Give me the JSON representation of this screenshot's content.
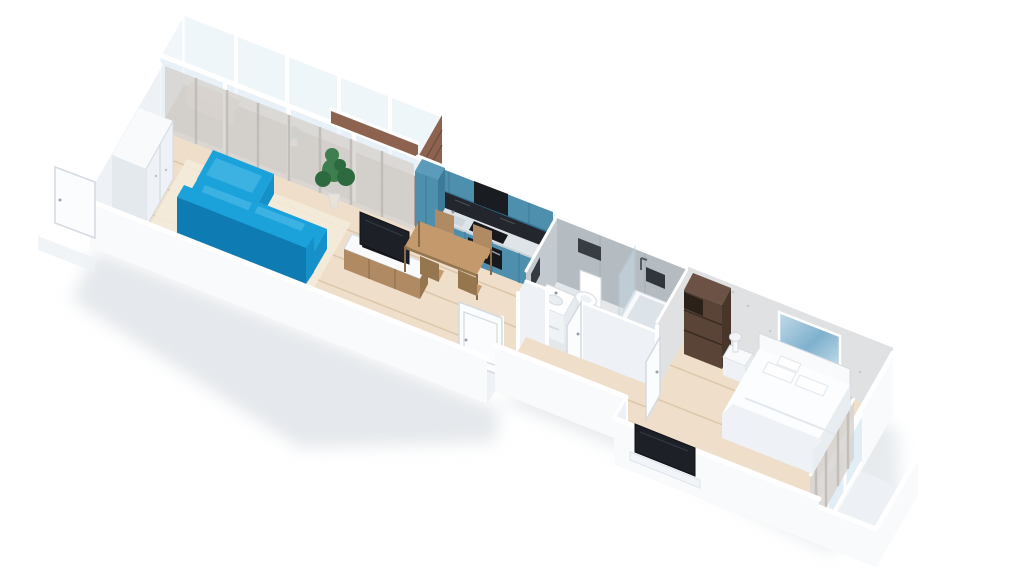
{
  "scene": {
    "title": "3D isometric render of a one-bedroom apartment floor plan on a white background",
    "view": "isometric cutaway dollhouse view, no text labels",
    "rooms": [
      {
        "name": "balcony",
        "features": [
          "glazed window wall",
          "dark wood deck",
          "wood bench",
          "small potted plant",
          "sheer curtains"
        ]
      },
      {
        "name": "living-room-kitchen",
        "features": [
          "blue corner sofa",
          "light rug",
          "white wardrobe",
          "tv sideboard with tv and soundbar",
          "tall potted plant",
          "dining table with four chairs",
          "teal kitchen cabinets",
          "dark stone backsplash",
          "built-in oven and cooktop",
          "sink"
        ]
      },
      {
        "name": "hallway",
        "features": [
          "light wood floor",
          "open white interior doors",
          "entrance door ajar"
        ]
      },
      {
        "name": "bathroom",
        "features": [
          "grey tile walls",
          "bathtub with glass screen",
          "shower fixture",
          "toilet",
          "vanity with mirror",
          "washing machine"
        ]
      },
      {
        "name": "bedroom",
        "features": [
          "double bed with white bedding and pillows",
          "upholstered headboard",
          "white nightstand with lamp",
          "dark brown wardrobe",
          "abstract blue wall art",
          "speckled wallpaper",
          "curtained window wall",
          "tv on low stand"
        ]
      },
      {
        "name": "bedroom-balcony",
        "features": [
          "white parapet walls"
        ]
      }
    ]
  },
  "colors": {
    "background": "#ffffff",
    "white": "#ffffff",
    "shadow": "#ccd2d9",
    "wallWhite": "#eef1f5",
    "wallBright": "#f8fafc",
    "doorFill": "#fbfcfe",
    "frameLine": "#d4dae1",
    "woodFloor": "#efdfca",
    "woodLine": "#ddc7ab",
    "deck": "#7c5a44",
    "brick": "#8d6350",
    "glass": "#e2eef6",
    "tileWall": "#b4bcc2",
    "tileSide": "#c3cacf",
    "bathFloor": "#e4e8eb",
    "tealCabinet": "#4f8fae",
    "tealCabinetDark": "#3e7b98",
    "tealCabinetLight": "#5c9cba",
    "counter": "#dfe4e8",
    "backsplash": "#23262c",
    "appliance": "#17191d",
    "sofa": "#1ba2da",
    "sofaMid": "#1590c8",
    "sofaDark": "#0e7cb2",
    "sofaLight": "#3cb2e3",
    "woodA": "#c49a6c",
    "woodB": "#b08a63",
    "woodC": "#96764f",
    "curtain": "#d8d5d1",
    "curtainLine": "#bcb8b3",
    "wallpaper": "#e0e1e3",
    "darkWood": "#5a4438",
    "darkWoodSide": "#48362b",
    "darkWoodTop": "#6b5244",
    "tv": "#1d2127",
    "plant": "#3f7e4f",
    "plantDark": "#2e6a3f",
    "artLight": "#c3dcea",
    "artDeep": "#7fb0cd"
  }
}
